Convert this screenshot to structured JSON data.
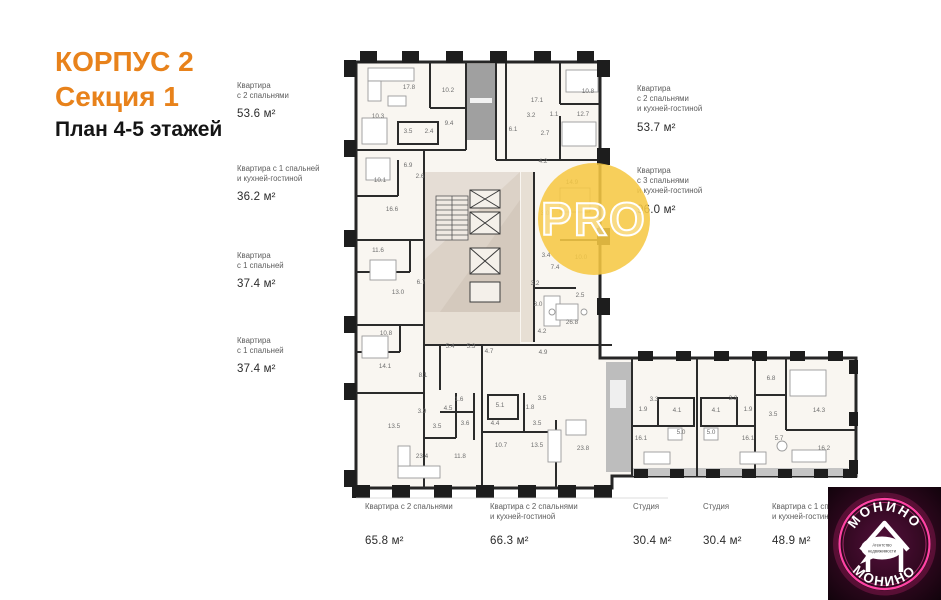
{
  "title": {
    "line1": "КОРПУС 2",
    "line2": "Секция 1",
    "line3": "План 4-5 этажей"
  },
  "colors": {
    "accent_orange": "#E8821B",
    "watermark_yellow": "#F6C844",
    "stamp_pink": "#FF3DA0"
  },
  "apartments": {
    "left": [
      {
        "name": "Квартира\nс 2 спальнями",
        "area": "53.6 м²"
      },
      {
        "name": "Квартира с 1 спальней\nи кухней-гостиной",
        "area": "36.2 м²"
      },
      {
        "name": "Квартира\nс 1 спальней",
        "area": "37.4 м²"
      },
      {
        "name": "Квартира\nс 1 спальней",
        "area": "37.4 м²"
      }
    ],
    "right": [
      {
        "name": "Квартира\nс 2 спальнями\nи кухней-гостиной",
        "area": "53.7 м²"
      },
      {
        "name": "Квартира\nс 3 спальнями\nи кухней-гостиной",
        "area": "96.0 м²"
      }
    ],
    "bottom": [
      {
        "name": "Квартира с 2 спальнями",
        "area": "65.8 м²"
      },
      {
        "name": "Квартира с 2 спальнями\nи кухней-гостиной",
        "area": "66.3 м²"
      },
      {
        "name": "Студия",
        "area": "30.4 м²"
      },
      {
        "name": "Студия",
        "area": "30.4 м²"
      },
      {
        "name": "Квартира с 1 спальней\nи кухней-гостиной",
        "area": "48.9 м²"
      }
    ]
  },
  "watermark": {
    "text": "PRO"
  },
  "stamp": {
    "arc_top": "МОНИНО",
    "arc_bottom": "МОНИНО",
    "bubble_line1": "Агентство",
    "bubble_line2": "недвижимости"
  },
  "plan": {
    "rooms": [
      {
        "v": "17.8",
        "x": 409,
        "y": 89
      },
      {
        "v": "10.2",
        "x": 448,
        "y": 92
      },
      {
        "v": "10.3",
        "x": 378,
        "y": 118
      },
      {
        "v": "3.5",
        "x": 408,
        "y": 133
      },
      {
        "v": "2.4",
        "x": 429,
        "y": 133
      },
      {
        "v": "9.4",
        "x": 449,
        "y": 125
      },
      {
        "v": "17.1",
        "x": 537,
        "y": 102
      },
      {
        "v": "10.8",
        "x": 588,
        "y": 93
      },
      {
        "v": "3.2",
        "x": 531,
        "y": 117
      },
      {
        "v": "1.1",
        "x": 554,
        "y": 116
      },
      {
        "v": "12.7",
        "x": 583,
        "y": 116
      },
      {
        "v": "6.1",
        "x": 513,
        "y": 131
      },
      {
        "v": "2.7",
        "x": 545,
        "y": 135
      },
      {
        "v": "6.9",
        "x": 408,
        "y": 167
      },
      {
        "v": "10.1",
        "x": 380,
        "y": 182
      },
      {
        "v": "2.6",
        "x": 420,
        "y": 178
      },
      {
        "v": "16.6",
        "x": 392,
        "y": 211
      },
      {
        "v": "11.6",
        "x": 378,
        "y": 252
      },
      {
        "v": "6.7",
        "x": 421,
        "y": 284
      },
      {
        "v": "13.0",
        "x": 398,
        "y": 294
      },
      {
        "v": "10.8",
        "x": 386,
        "y": 335
      },
      {
        "v": "14.1",
        "x": 385,
        "y": 368
      },
      {
        "v": "8.1",
        "x": 423,
        "y": 377
      },
      {
        "v": "4.2",
        "x": 543,
        "y": 163
      },
      {
        "v": "14.9",
        "x": 572,
        "y": 184
      },
      {
        "v": "3.0",
        "x": 545,
        "y": 215
      },
      {
        "v": "3.4",
        "x": 546,
        "y": 257
      },
      {
        "v": "7.4",
        "x": 555,
        "y": 269
      },
      {
        "v": "10.0",
        "x": 581,
        "y": 259
      },
      {
        "v": "3.2",
        "x": 535,
        "y": 285
      },
      {
        "v": "3.0",
        "x": 538,
        "y": 306
      },
      {
        "v": "2.5",
        "x": 580,
        "y": 297
      },
      {
        "v": "26.8",
        "x": 572,
        "y": 324
      },
      {
        "v": "5.4",
        "x": 450,
        "y": 348
      },
      {
        "v": "5.3",
        "x": 471,
        "y": 348
      },
      {
        "v": "4.7",
        "x": 489,
        "y": 353
      },
      {
        "v": "4.2",
        "x": 542,
        "y": 333
      },
      {
        "v": "4.9",
        "x": 543,
        "y": 354
      },
      {
        "v": "3.9",
        "x": 422,
        "y": 413
      },
      {
        "v": "4.5",
        "x": 448,
        "y": 410
      },
      {
        "v": "1.6",
        "x": 459,
        "y": 401
      },
      {
        "v": "3.6",
        "x": 465,
        "y": 425
      },
      {
        "v": "13.5",
        "x": 394,
        "y": 428
      },
      {
        "v": "3.5",
        "x": 437,
        "y": 428
      },
      {
        "v": "23.4",
        "x": 422,
        "y": 458
      },
      {
        "v": "11.8",
        "x": 460,
        "y": 458
      },
      {
        "v": "5.1",
        "x": 500,
        "y": 407
      },
      {
        "v": "4.4",
        "x": 495,
        "y": 425
      },
      {
        "v": "1.8",
        "x": 530,
        "y": 409
      },
      {
        "v": "3.5",
        "x": 542,
        "y": 400
      },
      {
        "v": "3.5",
        "x": 537,
        "y": 425
      },
      {
        "v": "10.7",
        "x": 501,
        "y": 447
      },
      {
        "v": "13.5",
        "x": 537,
        "y": 447
      },
      {
        "v": "23.8",
        "x": 583,
        "y": 450
      },
      {
        "v": "1.9",
        "x": 643,
        "y": 411
      },
      {
        "v": "3.3",
        "x": 654,
        "y": 401
      },
      {
        "v": "4.1",
        "x": 677,
        "y": 412
      },
      {
        "v": "5.0",
        "x": 681,
        "y": 434
      },
      {
        "v": "16.1",
        "x": 641,
        "y": 440
      },
      {
        "v": "3.3",
        "x": 733,
        "y": 400
      },
      {
        "v": "4.1",
        "x": 716,
        "y": 412
      },
      {
        "v": "1.9",
        "x": 748,
        "y": 411
      },
      {
        "v": "5.0",
        "x": 711,
        "y": 434
      },
      {
        "v": "16.1",
        "x": 748,
        "y": 440
      },
      {
        "v": "6.8",
        "x": 771,
        "y": 380
      },
      {
        "v": "3.5",
        "x": 773,
        "y": 416
      },
      {
        "v": "5.7",
        "x": 779,
        "y": 440
      },
      {
        "v": "14.3",
        "x": 819,
        "y": 412
      },
      {
        "v": "16.2",
        "x": 824,
        "y": 450
      }
    ]
  }
}
